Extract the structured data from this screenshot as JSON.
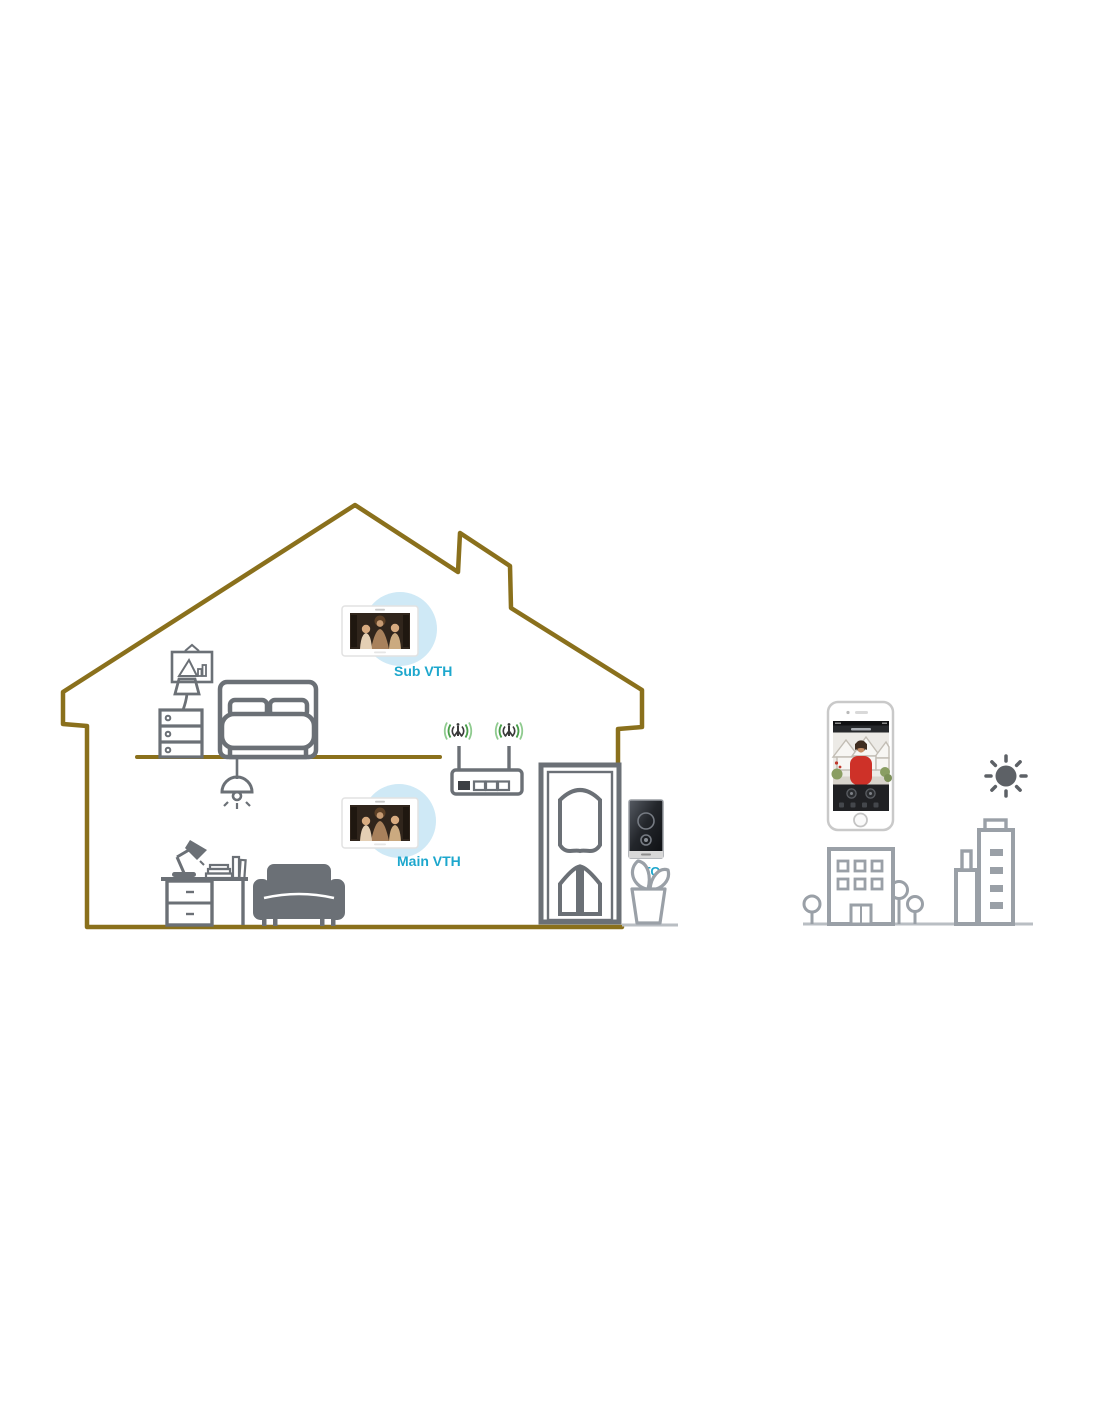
{
  "page": {
    "background": "#ffffff"
  },
  "diagram": {
    "name": "Smart home video intercom system diagram",
    "labels": {
      "sub_vth": "Sub VTH",
      "main_vth": "Main VTH",
      "vto": "VTO"
    },
    "colors": {
      "house_outline": "#8a701c",
      "furniture_gray": "#6b7076",
      "city_gray": "#9aa0a7",
      "ground_gray": "#b9bec3",
      "label_cyan": "#1da7cd",
      "wifi_green": "#4a9e4a",
      "wifi_green_light": "#8fcb8f",
      "vth_halo_blue": "#cfe9f6",
      "vto_body_dark": "#14161a",
      "sun_gray": "#5d6166",
      "phone_woman_red": "#ce3128"
    },
    "icons": [
      "house-outline",
      "picture-frame-icon",
      "bed-icon",
      "nightstand-icon",
      "table-lamp-icon",
      "ceiling-lamp-icon",
      "desk-icon",
      "desk-lamp-icon",
      "books-icon",
      "sofa-icon",
      "sub-vth-monitor-icon",
      "main-vth-monitor-icon",
      "wifi-router-icon",
      "wifi-signal-icon",
      "door-icon",
      "vto-doorbell-icon",
      "plant-icon",
      "smartphone-icon",
      "sun-icon",
      "tree-icon",
      "office-building-icon",
      "skyscraper-icon"
    ]
  }
}
